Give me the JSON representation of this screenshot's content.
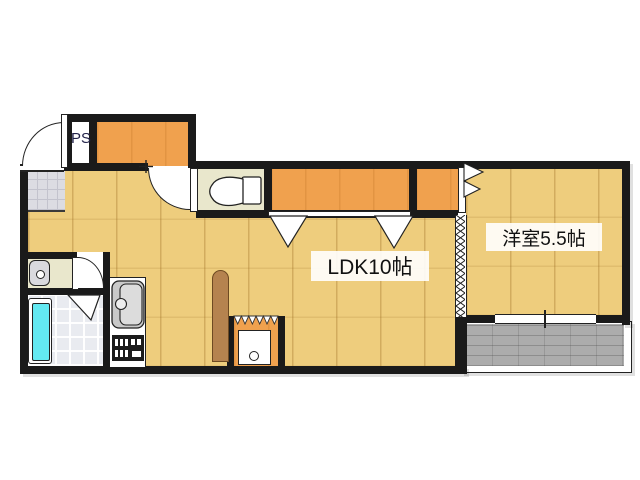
{
  "figure_type": "apartment-floorplan",
  "labels": {
    "pipe_space": "PS",
    "ldk": "LDK10帖",
    "western_room": "洋室5.5帖"
  },
  "colors": {
    "wall": "#1a1a1a",
    "wood_floor": "#eecd7d",
    "closet_orange": "#f0a14e",
    "toilet_washroom_floor": "#e9e7cc",
    "entrance_tile": "#dcdce2",
    "bathtub_cyan": "#63e9f2",
    "balcony_gray": "#acacac",
    "counter_brown": "#b5834f"
  },
  "fixtures": {
    "entrance_door": "swing-door-arc",
    "hall_door": "swing-door-arc",
    "washroom_door": "swing-door-arc",
    "bathroom_door": "folding-door-triangle",
    "closet_doors": "hinged-door-triangles",
    "ldk_partition": "accordion-zigzag-partition",
    "balcony_window": "sliding-window",
    "toilet": "toilet",
    "washbasin": "washbasin",
    "bathtub": "bathtub",
    "kitchen_sink": "sink",
    "stove": "stove",
    "washing_machine_space": "washing-machine-space",
    "balcony": "balcony"
  }
}
